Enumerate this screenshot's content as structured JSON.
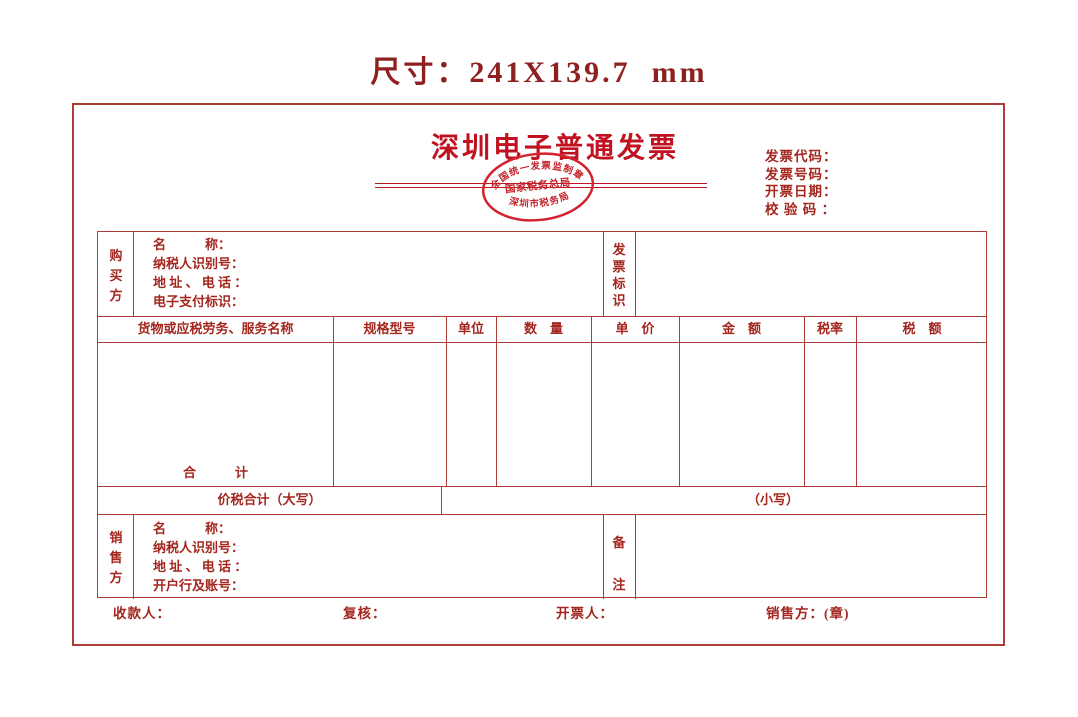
{
  "page_title": "尺寸：241X139.7  mm",
  "colors": {
    "label_text_red": "#a3261f",
    "table_rule_red": "#ad3b36",
    "invoice_title_red": "#c01220",
    "stamp_red": "#d4232e",
    "page_title_maroon": "#8e2020"
  },
  "invoice": {
    "title": "深圳电子普通发票",
    "stamp": {
      "top_arc": "全国统一发票监制章",
      "middle": "国家税务总局",
      "bottom_arc": "深圳市税务局"
    },
    "meta": {
      "code_label": "发票代码：",
      "number_label": "发票号码：",
      "date_label": "开票日期：",
      "checksum_label": "校 验 码 ："
    },
    "buyer": {
      "side_label": "购\n买\n方",
      "name_label": "名　　　称：",
      "tax_id_label": "纳税人识别号：",
      "address_phone_label": "地 址 、 电 话 ：",
      "epay_id_label": "电子支付标识：",
      "flag_side_label": "发\n票\n标\n识"
    },
    "table": {
      "headers": [
        "货物或应税劳务、服务名称",
        "规格型号",
        "单位",
        "数　量",
        "单　价",
        "金　额",
        "税率",
        "税　额"
      ],
      "total_label": "合　　　计"
    },
    "sum_row": {
      "amount_in_words_label": "价税合计（大写）",
      "amount_in_figures_label": "（小写）"
    },
    "seller": {
      "side_label": "销\n售\n方",
      "name_label": "名　　　称：",
      "tax_id_label": "纳税人识别号：",
      "address_phone_label": "地 址 、 电 话 ：",
      "bank_account_label": "开户行及账号：",
      "remark_side_label": "备\n\n注"
    },
    "footer": {
      "payee_label": "收款人：",
      "reviewer_label": "复核：",
      "issuer_label": "开票人：",
      "seller_seal_label": "销售方：(章)"
    }
  }
}
